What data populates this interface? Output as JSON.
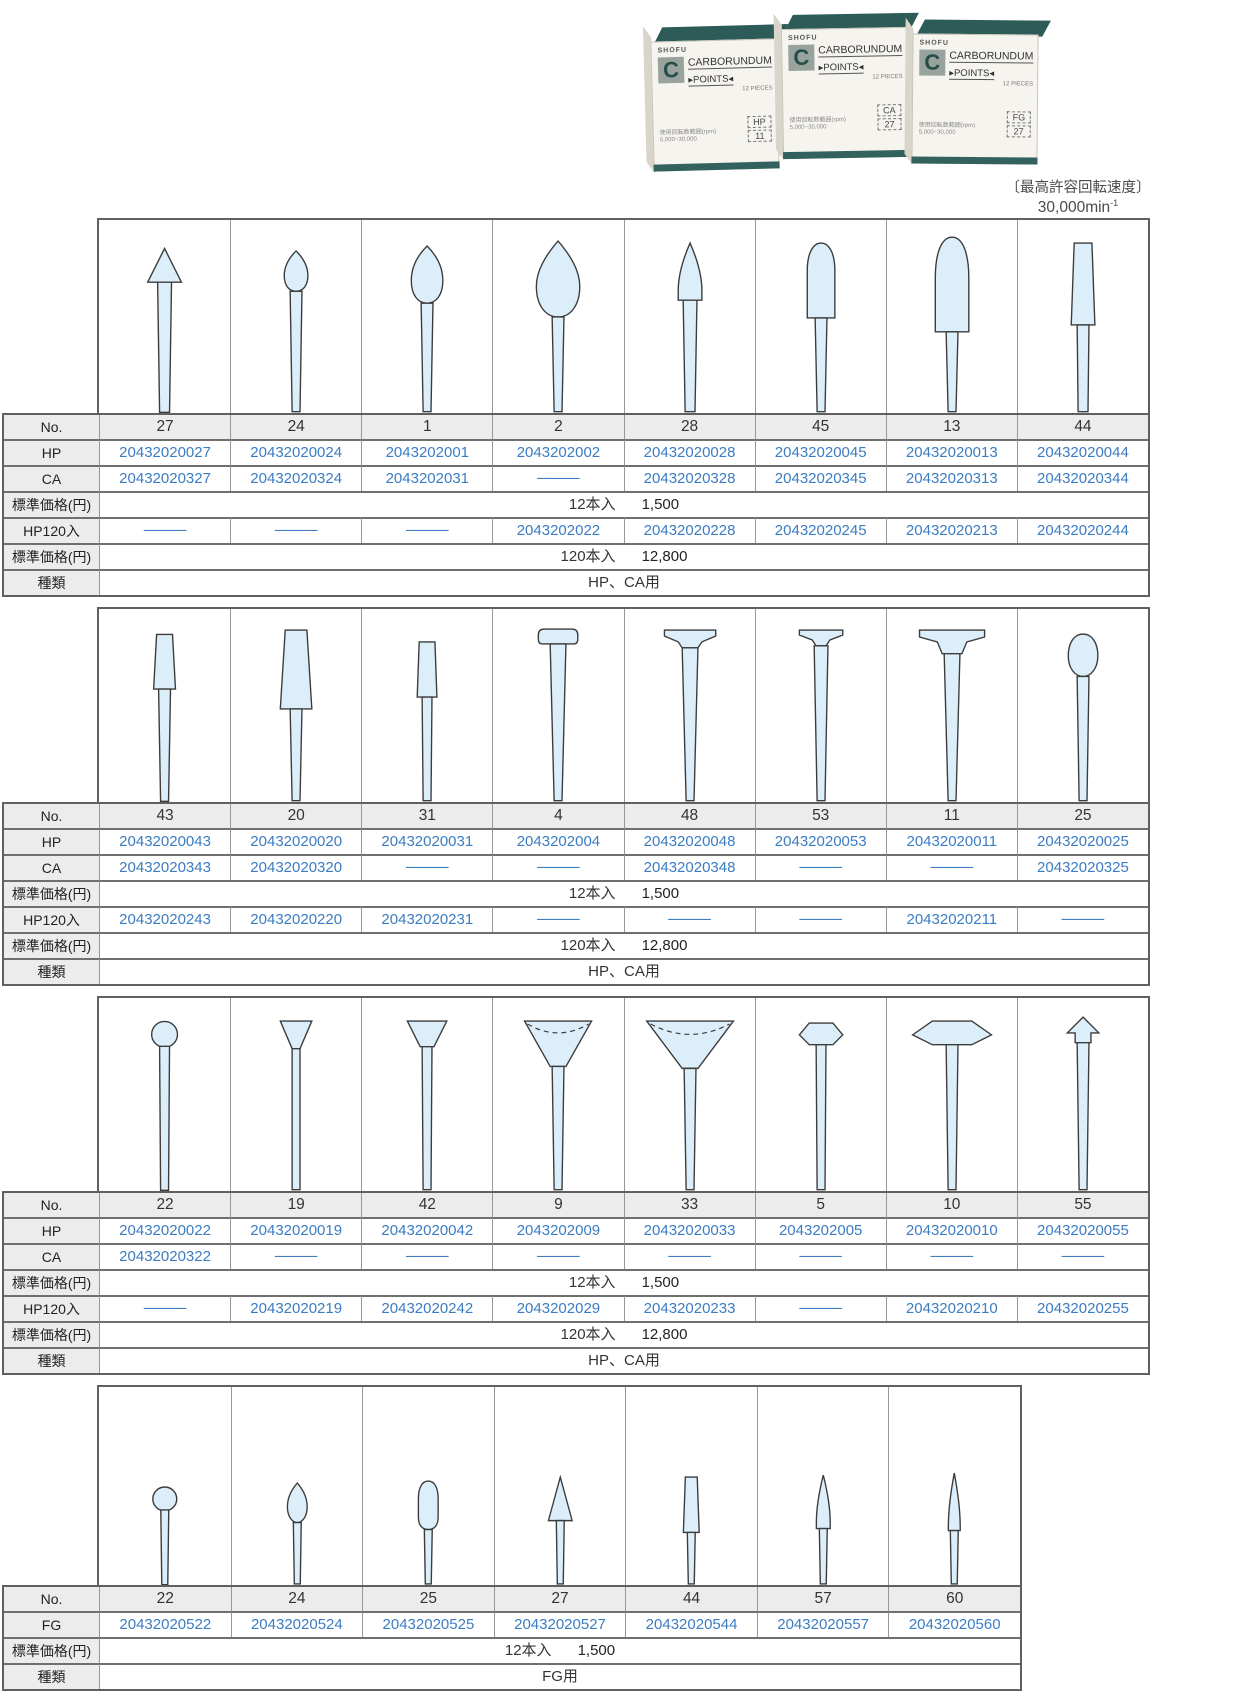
{
  "header": {
    "max_speed_label": "〔最高許容回転速度〕",
    "max_speed_value": "30,000min",
    "max_speed_sup": "-1",
    "boxes": [
      {
        "brand": "SHOFU",
        "product": "CARBORUNDUM",
        "product2": "▸POINTS◂",
        "pieces": "12 PIECES",
        "range_label": "使用回転数範囲(rpm)",
        "range": "5,000~30,000",
        "type": "HP",
        "number": "11"
      },
      {
        "brand": "SHOFU",
        "product": "CARBORUNDUM",
        "product2": "▸POINTS◂",
        "pieces": "12 PIECES",
        "range_label": "使用回転数範囲(rpm)",
        "range": "5,000~30,000",
        "type": "CA",
        "number": "27"
      },
      {
        "brand": "SHOFU",
        "product": "CARBORUNDUM",
        "product2": "▸POINTS◂",
        "pieces": "12 PIECES",
        "range_label": "使用回転数範囲(rpm)",
        "range": "5,000~30,000",
        "type": "FG",
        "number": "27"
      }
    ]
  },
  "row_labels": {
    "no": "No.",
    "hp": "HP",
    "ca": "CA",
    "fg": "FG",
    "price12": "標準価格(円)",
    "hp120": "HP120入",
    "price120": "標準価格(円)",
    "kind": "種類"
  },
  "tables": [
    {
      "name": "points-table-1",
      "width": 1148,
      "shape_height": 193,
      "rows": [
        "no",
        "hp",
        "ca",
        "price12",
        "hp120",
        "price120",
        "kind"
      ],
      "price12": {
        "pack": "12本入",
        "amount": "1,500"
      },
      "price120": {
        "pack": "120本入",
        "amount": "12,800"
      },
      "kind": "HP、CA用",
      "columns": [
        {
          "no": "27",
          "shape": "cone-tip",
          "hp": "20432020027",
          "ca": "20432020327",
          "hp120": "────"
        },
        {
          "no": "24",
          "shape": "bud-small",
          "hp": "20432020024",
          "ca": "20432020324",
          "hp120": "────"
        },
        {
          "no": "1",
          "shape": "egg",
          "hp": "2043202001",
          "ca": "2043202031",
          "hp120": "────"
        },
        {
          "no": "2",
          "shape": "teardrop-large",
          "hp": "2043202002",
          "ca": "────",
          "hp120": "2043202022"
        },
        {
          "no": "28",
          "shape": "flame",
          "hp": "20432020028",
          "ca": "20432020328",
          "hp120": "20432020228"
        },
        {
          "no": "45",
          "shape": "bullet",
          "hp": "20432020045",
          "ca": "20432020345",
          "hp120": "20432020245"
        },
        {
          "no": "13",
          "shape": "torpedo",
          "hp": "20432020013",
          "ca": "20432020313",
          "hp120": "20432020213"
        },
        {
          "no": "44",
          "shape": "taper-flat-top",
          "hp": "20432020044",
          "ca": "20432020344",
          "hp120": "20432020244"
        }
      ]
    },
    {
      "name": "points-table-2",
      "width": 1148,
      "shape_height": 193,
      "rows": [
        "no",
        "hp",
        "ca",
        "price12",
        "hp120",
        "price120",
        "kind"
      ],
      "price12": {
        "pack": "12本入",
        "amount": "1,500"
      },
      "price120": {
        "pack": "120本入",
        "amount": "12,800"
      },
      "kind": "HP、CA用",
      "columns": [
        {
          "no": "43",
          "shape": "taper-small",
          "hp": "20432020043",
          "ca": "20432020343",
          "hp120": "20432020243"
        },
        {
          "no": "20",
          "shape": "trapezoid",
          "hp": "20432020020",
          "ca": "20432020320",
          "hp120": "20432020220"
        },
        {
          "no": "31",
          "shape": "cylinder-small",
          "hp": "20432020031",
          "ca": "────",
          "hp120": "20432020231"
        },
        {
          "no": "4",
          "shape": "t-rounded",
          "hp": "2043202004",
          "ca": "────",
          "hp120": "────"
        },
        {
          "no": "48",
          "shape": "t-wide",
          "hp": "20432020048",
          "ca": "20432020348",
          "hp120": "────"
        },
        {
          "no": "53",
          "shape": "t-thin",
          "hp": "20432020053",
          "ca": "────",
          "hp120": "────"
        },
        {
          "no": "11",
          "shape": "t-umbrella",
          "hp": "20432020011",
          "ca": "────",
          "hp120": "20432020211"
        },
        {
          "no": "25",
          "shape": "oval",
          "hp": "20432020025",
          "ca": "20432020325",
          "hp120": "────"
        }
      ]
    },
    {
      "name": "points-table-3",
      "width": 1148,
      "shape_height": 193,
      "rows": [
        "no",
        "hp",
        "ca",
        "price12",
        "hp120",
        "price120",
        "kind"
      ],
      "price12": {
        "pack": "12本入",
        "amount": "1,500"
      },
      "price120": {
        "pack": "120本入",
        "amount": "12,800"
      },
      "kind": "HP、CA用",
      "columns": [
        {
          "no": "22",
          "shape": "ball",
          "hp": "20432020022",
          "ca": "20432020322",
          "hp120": "────"
        },
        {
          "no": "19",
          "shape": "inverted-cone",
          "hp": "20432020019",
          "ca": "────",
          "hp120": "20432020219"
        },
        {
          "no": "42",
          "shape": "inverted-trapezoid",
          "hp": "20432020042",
          "ca": "────",
          "hp120": "20432020242"
        },
        {
          "no": "9",
          "shape": "cup",
          "hp": "2043202009",
          "ca": "────",
          "hp120": "2043202029"
        },
        {
          "no": "33",
          "shape": "cup-wide",
          "hp": "20432020033",
          "ca": "────",
          "hp120": "20432020233"
        },
        {
          "no": "5",
          "shape": "hexagon",
          "hp": "2043202005",
          "ca": "────",
          "hp120": "────"
        },
        {
          "no": "10",
          "shape": "hexagon-wide",
          "hp": "20432020010",
          "ca": "────",
          "hp120": "20432020210"
        },
        {
          "no": "55",
          "shape": "arrowhead",
          "hp": "20432020055",
          "ca": "────",
          "hp120": "20432020255"
        }
      ]
    },
    {
      "name": "points-table-4",
      "width": 1020,
      "shape_height": 198,
      "rows": [
        "no",
        "fg",
        "price12",
        "kind"
      ],
      "price12": {
        "pack": "12本入",
        "amount": "1,500"
      },
      "kind": "FG用",
      "columns": [
        {
          "no": "22",
          "shape": "ball-small-fg",
          "fg": "20432020522"
        },
        {
          "no": "24",
          "shape": "bud-fg",
          "fg": "20432020524"
        },
        {
          "no": "25",
          "shape": "bud-long-fg",
          "fg": "20432020525"
        },
        {
          "no": "27",
          "shape": "cone-fg",
          "fg": "20432020527"
        },
        {
          "no": "44",
          "shape": "taper-flat-fg",
          "fg": "20432020544"
        },
        {
          "no": "57",
          "shape": "taper-point-fg",
          "fg": "20432020557"
        },
        {
          "no": "60",
          "shape": "taper-sharp-fg",
          "fg": "20432020560"
        }
      ]
    }
  ]
}
